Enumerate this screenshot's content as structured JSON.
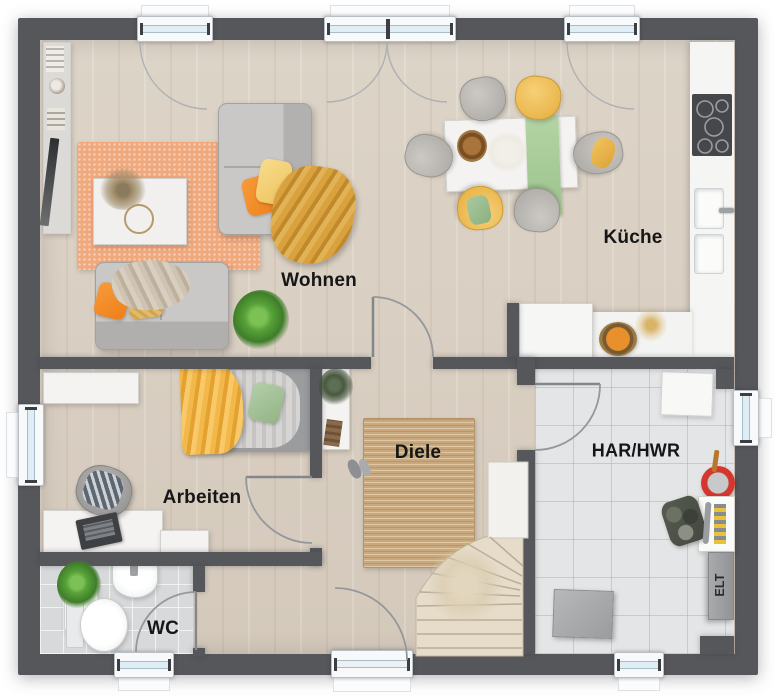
{
  "plan": {
    "rooms": {
      "wohnen": "Wohnen",
      "kueche": "Küche",
      "arbeiten": "Arbeiten",
      "diele": "Diele",
      "wc": "WC",
      "har_hwr": "HAR/HWR",
      "elt": "ELT"
    },
    "palette": {
      "wall": "#55575b",
      "wood_floor": "#d8cec2",
      "tile_floor": "#e3e5e6",
      "rug_orange": "#f0a87d",
      "rug_jute": "#c8a87c",
      "sofa_gray": "#c3c2c0",
      "accent_orange": "#f5922e",
      "accent_yellow": "#f2c35c",
      "accent_green": "#a9c9a0",
      "stairs_wood": "#e6dcc9",
      "window_glass": "#dfeef5",
      "bucket_red": "#d5372e"
    }
  }
}
